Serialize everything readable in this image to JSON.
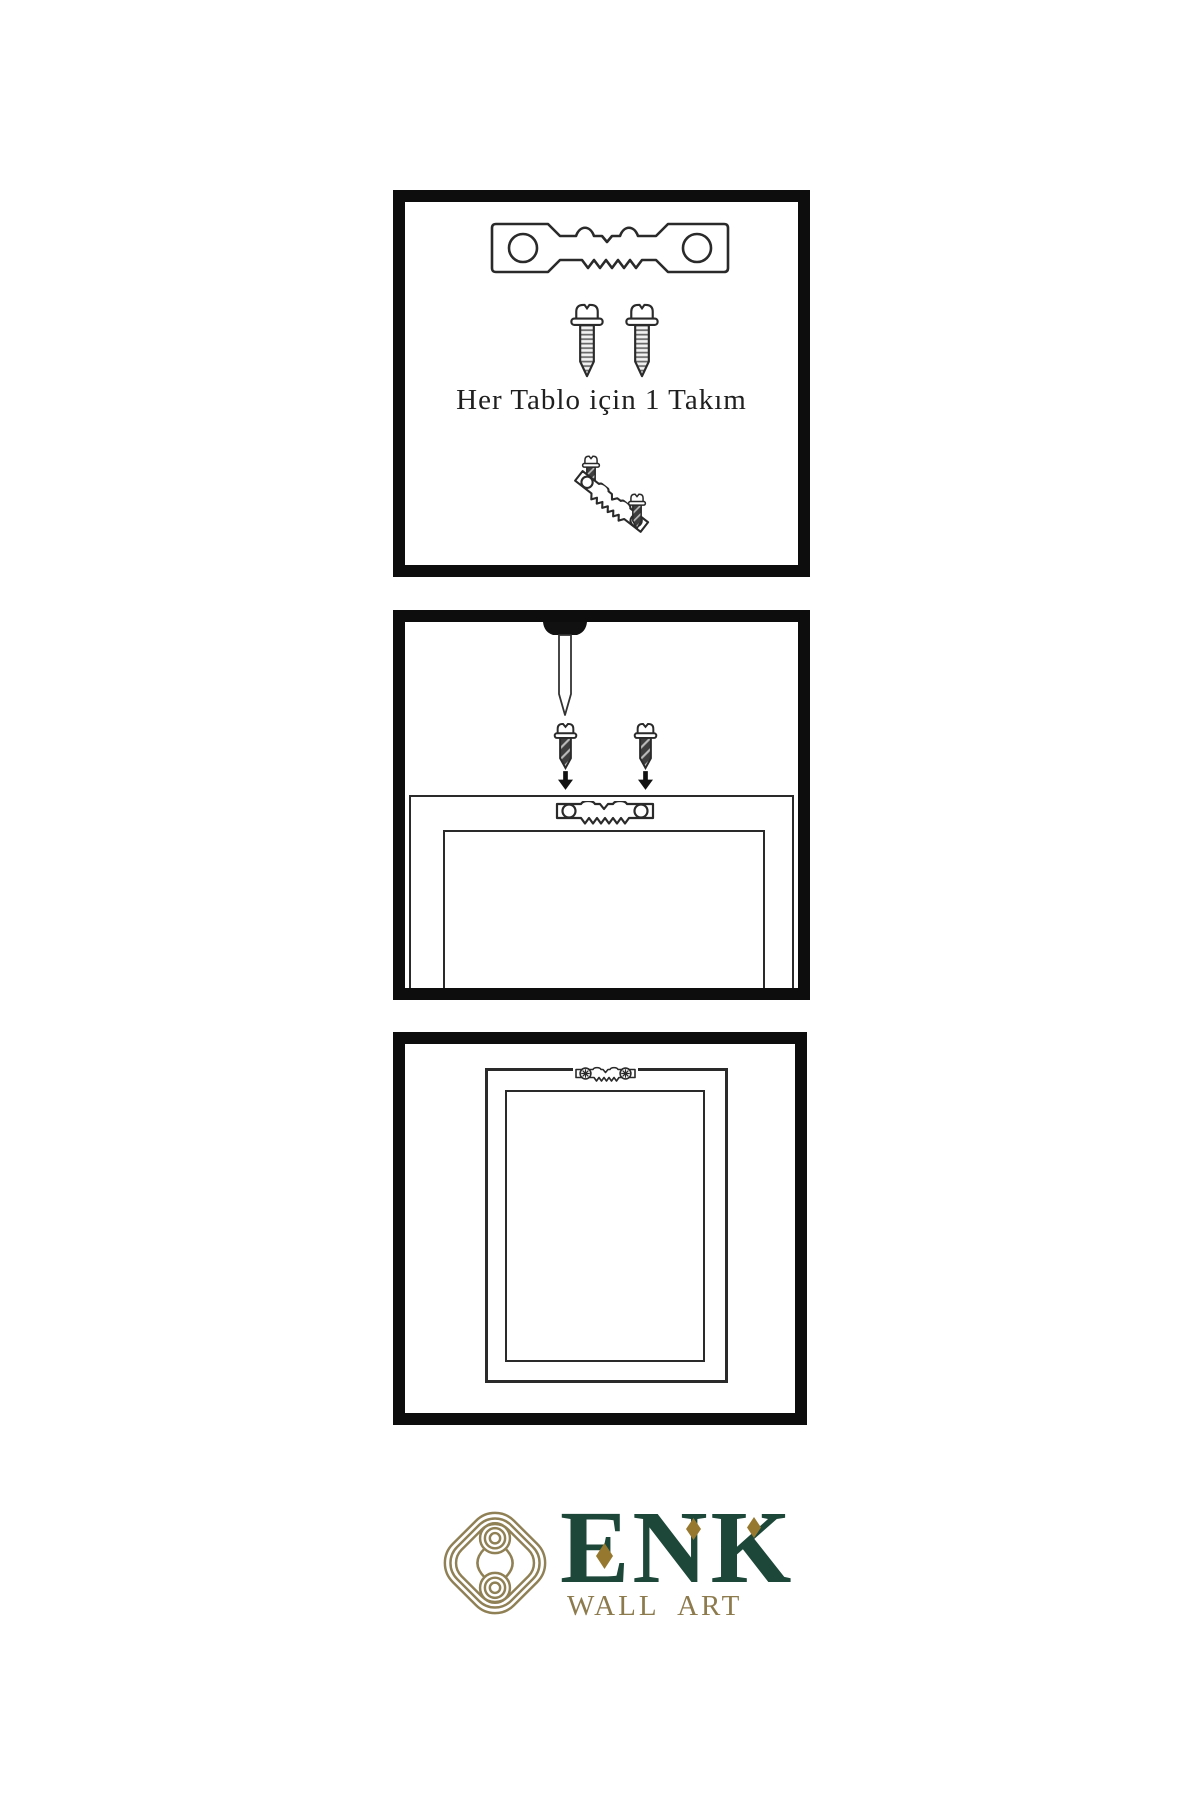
{
  "instructions": {
    "panel1": {
      "caption": "Her Tablo için 1 Takım"
    },
    "panel2": {
      "caption": ""
    },
    "panel3": {
      "caption": ""
    }
  },
  "brand": {
    "name": "ENK",
    "subtitle": "WALL ART"
  },
  "colors": {
    "background": "#ffffff",
    "panel_border": "#0d0d0d",
    "line_art": "#2a2a2a",
    "screw_dark": "#3e3e3e",
    "brand_green": "#1c4739",
    "knot_gold": "#8f8055",
    "subtitle_gold": "#8d7b4e",
    "diamond_gold": "#96782f"
  },
  "icons": {
    "sawtooth_hanger": "sawtooth-hanger-icon",
    "screw": "screw-icon",
    "wall_nail": "wall-nail-icon",
    "arrow_down": "arrow-down-icon",
    "knot": "knot-icon",
    "diamond": "diamond-icon"
  }
}
